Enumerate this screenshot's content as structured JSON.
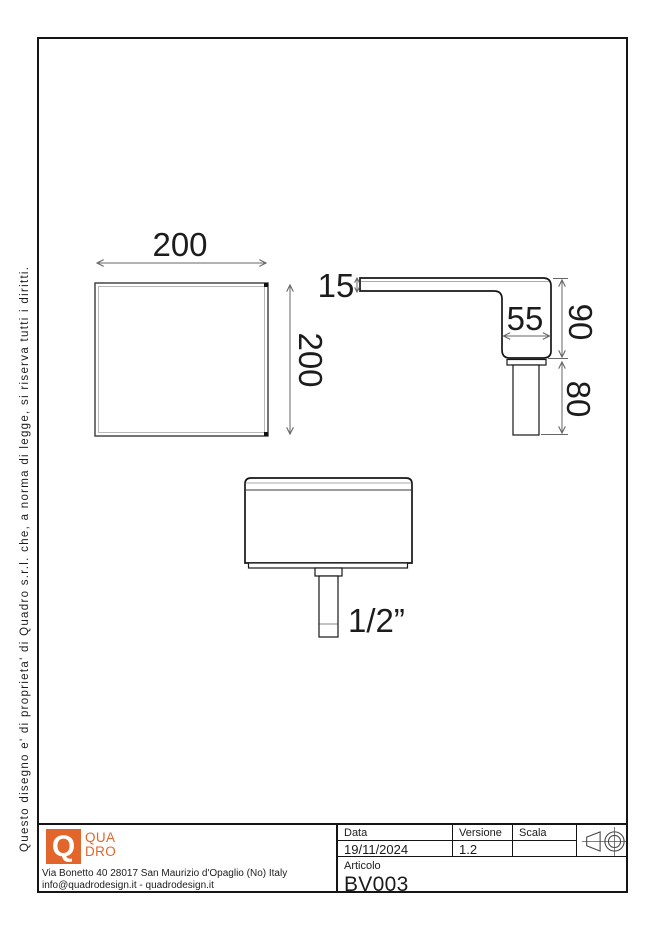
{
  "copyright": "Questo disegno e' di proprieta' di Quadro s.r.l. che, a norma di legge, si riserva tutti i diritti.",
  "views": {
    "top": {
      "dim_width": "200",
      "dim_height": "200"
    },
    "side": {
      "dim_plate_thickness": "15",
      "dim_body_width": "55",
      "dim_body_height": "90",
      "dim_pipe_length": "80"
    },
    "front": {
      "dim_thread": "1/2”"
    }
  },
  "title_block": {
    "company": {
      "q_mark": "Q",
      "name_line1": "QUA",
      "name_line2": "DRO",
      "brand_color": "#E2662C",
      "address": "Via Bonetto 40  28017 San Maurizio d'Opaglio (No) Italy",
      "contacts": "info@quadrodesign.it  -  quadrodesign.it"
    },
    "fields": {
      "data": {
        "label": "Data",
        "value": "19/11/2024"
      },
      "versione": {
        "label": "Versione",
        "value": "1.2"
      },
      "scala": {
        "label": "Scala",
        "value": ""
      },
      "articolo": {
        "label": "Articolo",
        "value": "BV003"
      }
    },
    "projection_symbol_icon": "first-angle-projection-icon"
  }
}
